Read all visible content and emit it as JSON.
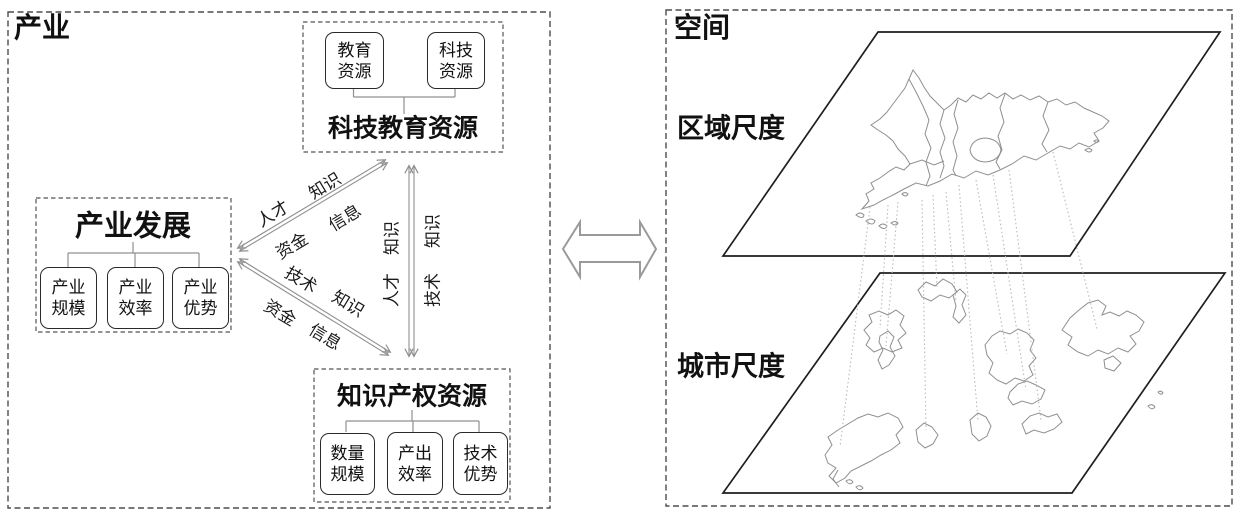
{
  "panels": {
    "industry": {
      "label": "产业",
      "groups": {
        "tech_edu": {
          "title": "科技教育资源",
          "boxes": [
            {
              "line1": "教育",
              "line2": "资源"
            },
            {
              "line1": "科技",
              "line2": "资源"
            }
          ]
        },
        "industry_dev": {
          "title": "产业发展",
          "boxes": [
            {
              "line1": "产业",
              "line2": "规模"
            },
            {
              "line1": "产业",
              "line2": "效率"
            },
            {
              "line1": "产业",
              "line2": "优势"
            }
          ]
        },
        "ip": {
          "title": "知识产权资源",
          "boxes": [
            {
              "line1": "数量",
              "line2": "规模"
            },
            {
              "line1": "产出",
              "line2": "效率"
            },
            {
              "line1": "技术",
              "line2": "优势"
            }
          ]
        }
      },
      "flows": {
        "dev_techedu": {
          "labels": [
            "人才",
            "知识",
            "资金",
            "信息"
          ]
        },
        "dev_ip": {
          "labels": [
            "技术",
            "知识",
            "资金",
            "信息"
          ]
        },
        "techedu_ip": {
          "labels": [
            "知识",
            "人才",
            "知识",
            "技术"
          ]
        }
      }
    },
    "space": {
      "label": "空间",
      "scales": [
        {
          "label": "区域尺度"
        },
        {
          "label": "城市尺度"
        }
      ]
    }
  },
  "colors": {
    "background": "#ffffff",
    "text": "#111111",
    "node_border": "#2a2a2a",
    "dashed_border": "#4d4d4d",
    "connector_gray": "#909090",
    "big_arrow_outline": "#9a9a9a",
    "plane_outline": "#1f1f1f",
    "map_outline": "#8f8f8f",
    "projection_dotted": "#b9b9b9"
  }
}
